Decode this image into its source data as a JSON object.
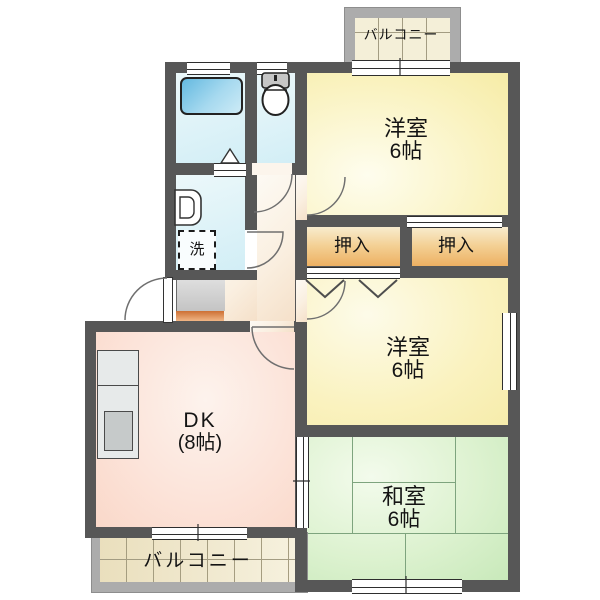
{
  "plan_title": "2DK apartment floor plan",
  "rooms": {
    "western_top": {
      "name": "洋室",
      "size": "6帖"
    },
    "western_mid": {
      "name": "洋室",
      "size": "6帖"
    },
    "japanese": {
      "name": "和室",
      "size": "6帖"
    },
    "dining_kitchen": {
      "name": "DK",
      "size": "(8帖)"
    },
    "closet_left": {
      "label": "押入"
    },
    "closet_right": {
      "label": "押入"
    },
    "balcony_top": {
      "label": "バルコニー"
    },
    "balcony_bottom": {
      "label": "バルコニー"
    },
    "laundry": {
      "label": "洗"
    }
  },
  "colors": {
    "wall": "#575757",
    "western_room_fill": "#f8f0b8",
    "japanese_room_fill": "#d9f0cc",
    "dk_fill": "#fbdfd2",
    "hall_fill": "#f8ecdb",
    "closet_fill": "#f0bd70",
    "wet_area_fill": "#d9f1f7",
    "bathtub_fill": "#7cc4e6",
    "balcony_frame": "#acacac",
    "balcony_floor": "#efe7c8",
    "tatami_line": "#7ea47e"
  }
}
